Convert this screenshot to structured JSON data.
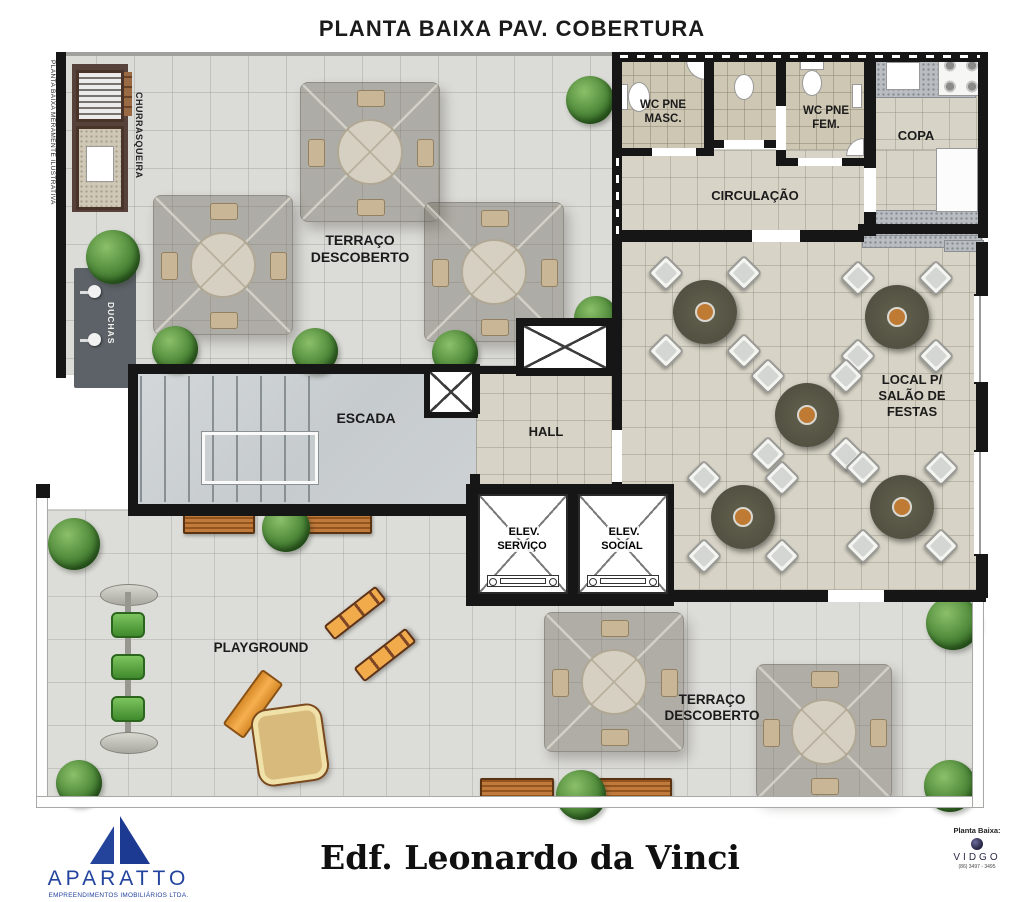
{
  "title": "PLANTA BAIXA PAV. COBERTURA",
  "disclaimer": "PLANTA BAIXA MERAMENTE ILUSTRATIVA",
  "rooms": {
    "terraco_top": "TERRAÇO\nDESCOBERTO",
    "terraco_bottom": "TERRAÇO\nDESCOBERTO",
    "churrasqueira": "CHURRASQUEIRA",
    "duchas": "DUCHAS",
    "wc_masc": "WC PNE\nMASC.",
    "wc_fem": "WC PNE\nFEM.",
    "copa": "COPA",
    "circulacao": "CIRCULAÇÃO",
    "escada": "ESCADA",
    "hall": "HALL",
    "elev_servico": "ELEV.\nSERVIÇO",
    "elev_social": "ELEV.\nSOCIAL",
    "salao": "LOCAL P/\nSALÃO DE\nFESTAS",
    "playground": "PLAYGROUND"
  },
  "footer": {
    "building_name": "Edf. Leonardo da Vinci",
    "developer": {
      "name": "APARATTO",
      "subtitle": "EMPREENDIMENTOS IMOBILIÁRIOS LTDA."
    },
    "credit": {
      "label": "Planta Baixa:",
      "studio": "VIDGO",
      "phone": "(86) 3497 - 3495"
    }
  },
  "colors": {
    "wall": "#161616",
    "accent_blue": "#23449e",
    "plant_green": "#3f8a2c",
    "wood": "#b06a32",
    "play_orange": "#f0a848",
    "floor_tile": "#d7d3c6"
  }
}
